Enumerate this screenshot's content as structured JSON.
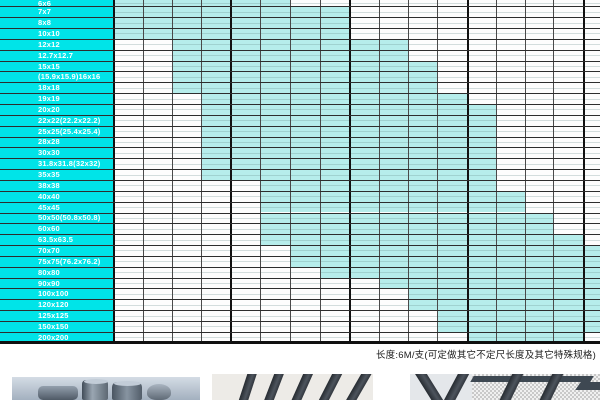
{
  "table": {
    "note": "长度:6M/支(可定做其它不定尺长度及其它特殊规格)",
    "columns_count": 17,
    "legend_meaning": "cyan-cell = size available",
    "rows": [
      {
        "label": "6x6",
        "run": [
          0,
          5
        ]
      },
      {
        "label": "7x7",
        "run": [
          0,
          7
        ]
      },
      {
        "label": "8x8",
        "run": [
          0,
          7
        ]
      },
      {
        "label": "10x10",
        "run": [
          0,
          7
        ]
      },
      {
        "label": "12x12",
        "run": [
          2,
          9
        ]
      },
      {
        "label": "12.7x12.7",
        "run": [
          2,
          9
        ]
      },
      {
        "label": "15x15",
        "run": [
          2,
          10
        ]
      },
      {
        "label": "(15.9x15.9)16x16",
        "run": [
          2,
          10
        ]
      },
      {
        "label": "18x18",
        "run": [
          2,
          10
        ]
      },
      {
        "label": "19x19",
        "run": [
          3,
          11
        ]
      },
      {
        "label": "20x20",
        "run": [
          3,
          12
        ]
      },
      {
        "label": "22x22(22.2x22.2)",
        "run": [
          3,
          12
        ]
      },
      {
        "label": "25x25(25.4x25.4)",
        "run": [
          3,
          12
        ]
      },
      {
        "label": "28x28",
        "run": [
          3,
          12
        ]
      },
      {
        "label": "30x30",
        "run": [
          3,
          12
        ]
      },
      {
        "label": "31.8x31.8(32x32)",
        "run": [
          3,
          12
        ]
      },
      {
        "label": "35x35",
        "run": [
          3,
          12
        ]
      },
      {
        "label": "38x38",
        "run": [
          5,
          12
        ]
      },
      {
        "label": "40x40",
        "run": [
          5,
          13
        ]
      },
      {
        "label": "45x45",
        "run": [
          5,
          13
        ]
      },
      {
        "label": "50x50(50.8x50.8)",
        "run": [
          5,
          14
        ]
      },
      {
        "label": "60x60",
        "run": [
          5,
          14
        ]
      },
      {
        "label": "63.5x63.5",
        "run": [
          5,
          15
        ]
      },
      {
        "label": "70x70",
        "run": [
          6,
          16
        ]
      },
      {
        "label": "75x75(76.2x76.2)",
        "run": [
          6,
          16
        ]
      },
      {
        "label": "80x80",
        "run": [
          7,
          16
        ]
      },
      {
        "label": "90x90",
        "run": [
          9,
          16
        ]
      },
      {
        "label": "100x100",
        "run": [
          10,
          16
        ]
      },
      {
        "label": "120x120",
        "run": [
          10,
          16
        ]
      },
      {
        "label": "125x125",
        "run": [
          11,
          16
        ]
      },
      {
        "label": "150x150",
        "run": [
          11,
          16
        ]
      },
      {
        "label": "200x200",
        "run": [
          12,
          15
        ]
      }
    ]
  },
  "colors": {
    "label_column": "#00e4e8",
    "available_cell": "#b6edeb",
    "label_text": "#ffffff",
    "grid_line": "#2e2e2e"
  },
  "photos": [
    {
      "name": "steel-round-billets"
    },
    {
      "name": "flat-bars-fanned"
    },
    {
      "name": "square-bars-angled"
    },
    {
      "name": "halftone-bars"
    }
  ]
}
